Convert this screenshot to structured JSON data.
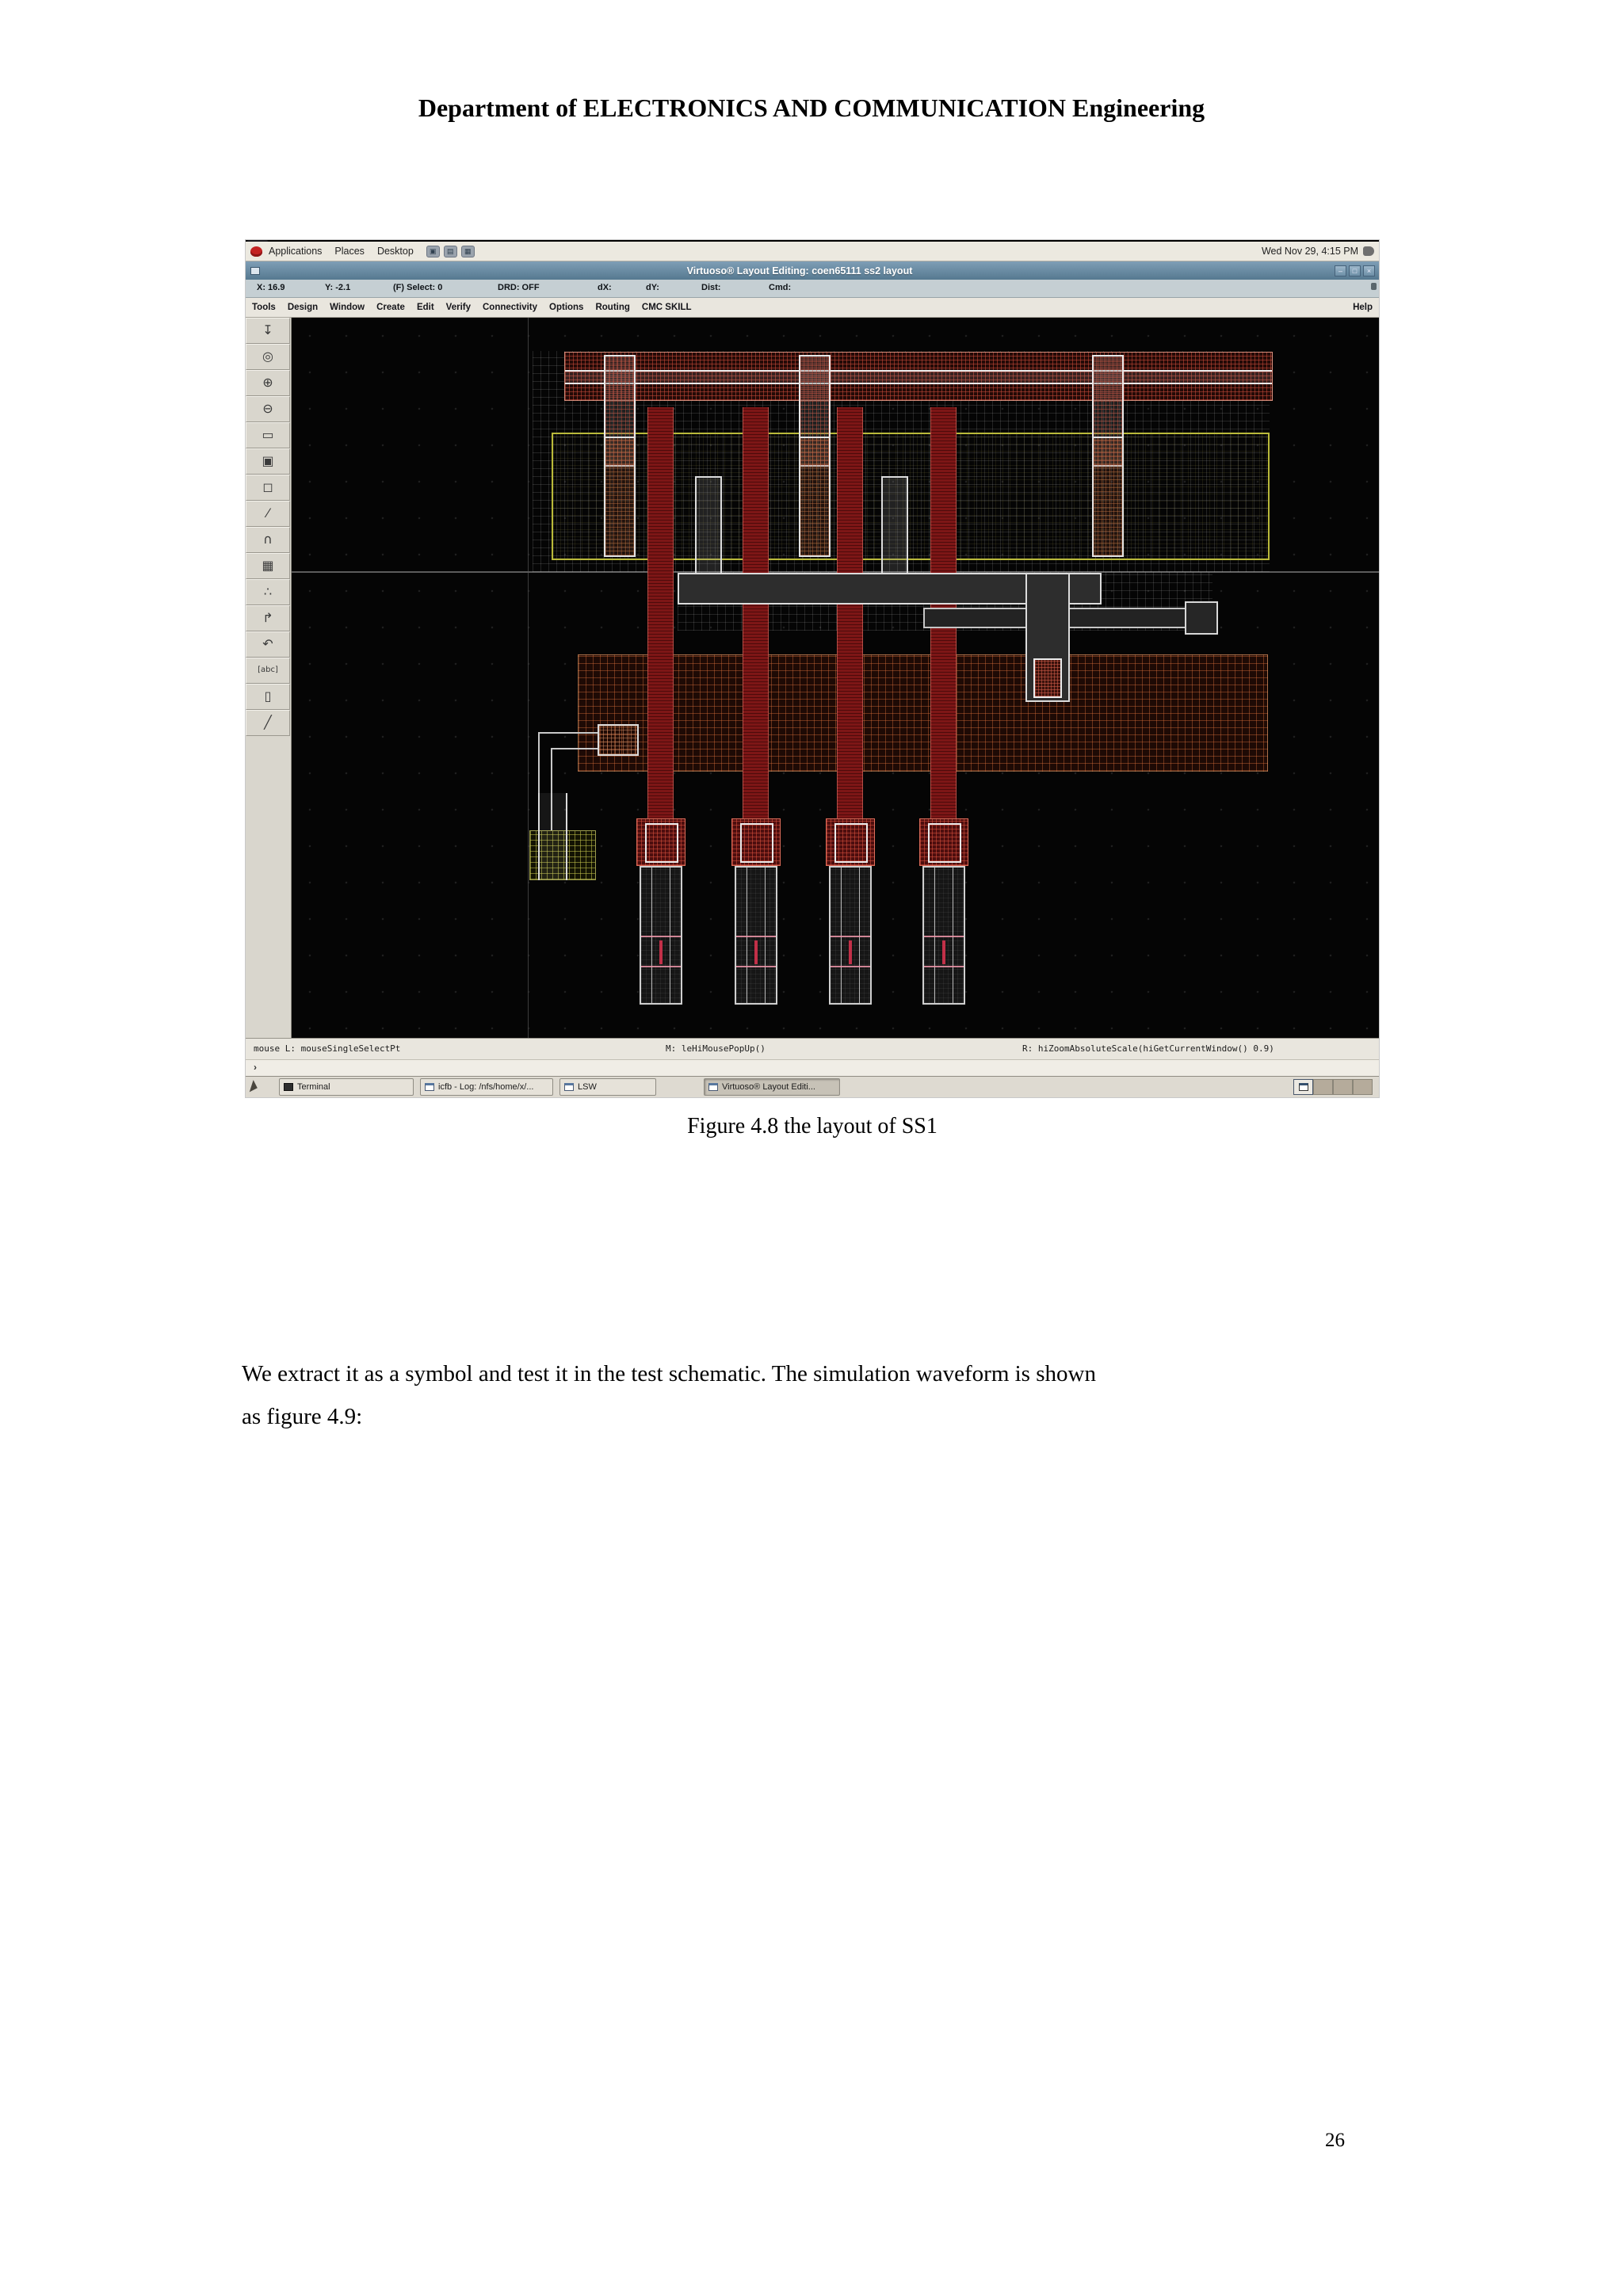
{
  "document": {
    "header": "Department of ELECTRONICS AND COMMUNICATION Engineering",
    "caption": "Figure 4.8 the layout of SS1",
    "body_line1": "We extract it as a symbol and test it in the test schematic. The simulation waveform is shown",
    "body_line2": "as figure 4.9:",
    "page_number": "26"
  },
  "desktop_panel": {
    "menus": [
      "Applications",
      "Places",
      "Desktop"
    ],
    "clock": "Wed Nov 29,  4:15 PM"
  },
  "window": {
    "title": "Virtuoso® Layout Editing: coen65111 ss2 layout",
    "buttons": {
      "minimize": "–",
      "maximize": "□",
      "close": "×"
    },
    "coord": {
      "x": "X: 16.9",
      "y": "Y: -2.1",
      "select": "(F) Select: 0",
      "drd": "DRD: OFF",
      "dx": "dX:",
      "dy": "dY:",
      "dist": "Dist:",
      "cmd": "Cmd:"
    },
    "menu_items": [
      "Tools",
      "Design",
      "Window",
      "Create",
      "Edit",
      "Verify",
      "Connectivity",
      "Options",
      "Routing",
      "CMC SKILL"
    ],
    "help": "Help",
    "mouse": {
      "left": "mouse L: mouseSingleSelectPt",
      "middle": "M: leHiMousePopUp()",
      "right": "R: hiZoomAbsoluteScale(hiGetCurrentWindow() 0.9)"
    },
    "prompt": "›"
  },
  "toolbar": {
    "icons": [
      {
        "name": "place-instance-icon",
        "glyph": "↧"
      },
      {
        "name": "redraw-icon",
        "glyph": "◎"
      },
      {
        "name": "zoom-in-icon",
        "glyph": "⊕"
      },
      {
        "name": "zoom-out-icon",
        "glyph": "⊖"
      },
      {
        "name": "stretch-icon",
        "glyph": "▭"
      },
      {
        "name": "copy-icon",
        "glyph": "▣"
      },
      {
        "name": "move-icon",
        "glyph": "◻"
      },
      {
        "name": "knife-icon",
        "glyph": "⁄"
      },
      {
        "name": "path-icon",
        "glyph": "∩"
      },
      {
        "name": "fill-pattern-icon",
        "glyph": "▦"
      },
      {
        "name": "instances-icon",
        "glyph": "∴"
      },
      {
        "name": "wire-icon",
        "glyph": "↱"
      },
      {
        "name": "undo-icon",
        "glyph": "↶"
      },
      {
        "name": "label-icon",
        "glyph": "[abc]"
      },
      {
        "name": "rect-icon",
        "glyph": "▯"
      },
      {
        "name": "ruler-icon",
        "glyph": "╱"
      }
    ]
  },
  "taskbar": {
    "items": [
      {
        "label": "Terminal"
      },
      {
        "label": "icfb - Log: /nfs/home/x/..."
      },
      {
        "label": "LSW"
      },
      {
        "label": "Virtuoso® Layout Editi..."
      }
    ]
  },
  "colors": {
    "titlebar_blue": "#6c8ea8",
    "panel_beige": "#ece9e0",
    "canvas_black": "#050505",
    "poly_red": "#7d1616",
    "nwell_yellow": "#b9b93a",
    "metal_white": "#dcdcdc",
    "diffusion_orange": "#e1733c"
  }
}
